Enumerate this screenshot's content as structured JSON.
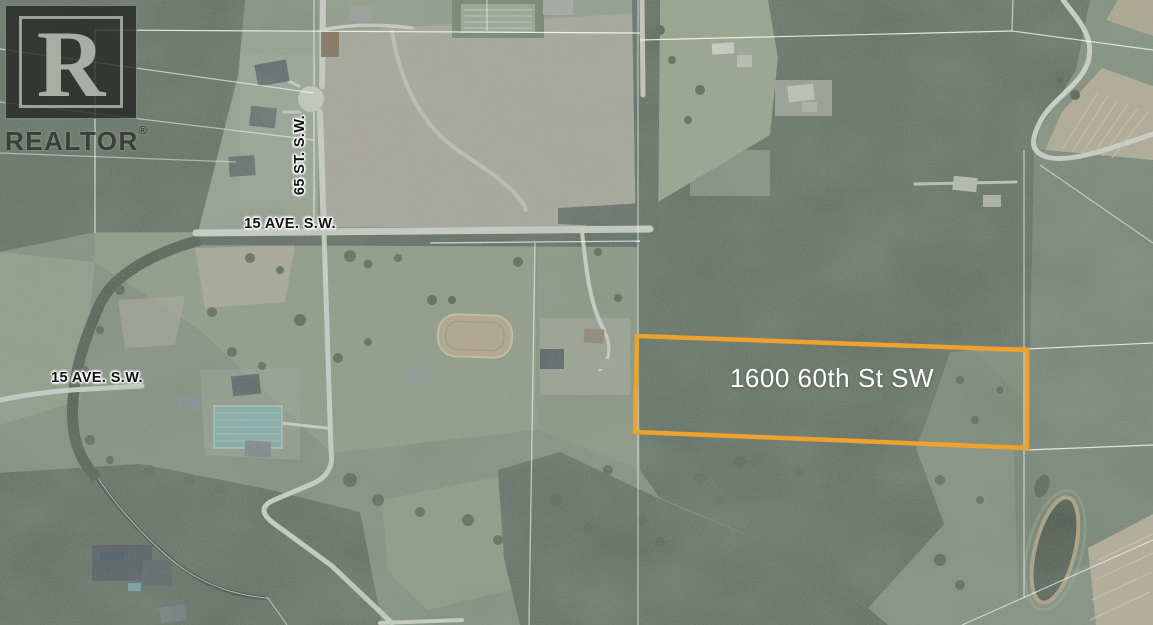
{
  "map": {
    "type": "aerial-property-listing-map",
    "watermark": {
      "logo_letter": "R",
      "brand": "REALTOR",
      "reg": "®"
    },
    "labels": {
      "street_vertical": "65 ST. S.W.",
      "avenue_top": "15 AVE. S.W.",
      "avenue_left": "15 AVE. S.W.",
      "property": "1600 60th St SW"
    },
    "colors": {
      "property_outline": "#EBA32E",
      "property_label_text": "#FFFFFF",
      "street_label_text": "#121212",
      "cadastral_line": "#FFFFFF"
    }
  }
}
